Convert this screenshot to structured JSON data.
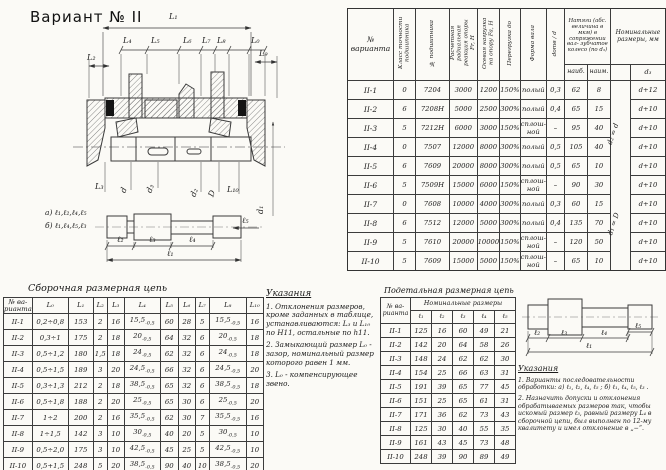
{
  "page_title": "Вариант № II",
  "drawing": {
    "dim_labels": {
      "L1": "L₁",
      "L2": "L₂",
      "L4": "L₄",
      "L5": "L₅",
      "L6": "L₆",
      "L7": "L₇",
      "L8": "L₈",
      "L0": "L₀",
      "L9": "L₉",
      "L3": "L₃",
      "d": "d",
      "d3": "d₃",
      "d2": "d₂",
      "D": "D",
      "L10": "L₁₀",
      "d1": "d₁"
    },
    "variant_note_a": "а) ℓ₁,ℓ₂,ℓ₄,ℓ₅",
    "variant_note_b": "б) ℓ₁,ℓ₄,ℓ₅,ℓ₃",
    "shaft_dims": {
      "l1": "ℓ₁",
      "l2": "ℓ₂",
      "l3": "ℓ₃",
      "l4": "ℓ₄",
      "l5": "ℓ₅"
    }
  },
  "main_table": {
    "headers": {
      "variant": "№ варианта",
      "accuracy_class": "Класс точности подшипника",
      "bearing_no": "№ подшипника",
      "radial_reaction": "Расчетная радиальная реакция опоры Fr, Н",
      "axial_load": "Осевая нагрузка на опору Fa, Н",
      "overload": "Перегрузка до",
      "shaft_form": "Форма вала",
      "d_ratio": "dотв / d",
      "interference": "Натяги (абс. величина в мкм) в сопряжении вал- зубчатое колесо (по d₃)",
      "max": "наиб.",
      "min": "наим.",
      "nominal": "Номинальные размеры, мм",
      "d3": "d₃"
    },
    "rot_top": "d₂ = d",
    "rot_bottom": "d₁ = D",
    "rows": [
      [
        "II-1",
        "0",
        "7204",
        "3000",
        "1200",
        "150%",
        "полый",
        "0,3",
        "62",
        "8",
        "",
        "d+12"
      ],
      [
        "II-2",
        "6",
        "7208Н",
        "5000",
        "2500",
        "300%",
        "полый",
        "0,4",
        "65",
        "15",
        "",
        "d+10"
      ],
      [
        "II-3",
        "5",
        "7212Н",
        "6000",
        "3000",
        "150%",
        "сплош-ной",
        "–",
        "95",
        "40",
        "",
        "d+10"
      ],
      [
        "II-4",
        "0",
        "7507",
        "12000",
        "8000",
        "300%",
        "полый",
        "0,5",
        "105",
        "40",
        "",
        "d+10"
      ],
      [
        "II-5",
        "6",
        "7609",
        "20000",
        "8000",
        "300%",
        "полый",
        "0,5",
        "65",
        "10",
        "",
        "d+10"
      ],
      [
        "II-6",
        "5",
        "7509Н",
        "15000",
        "6000",
        "150%",
        "сплош-ной",
        "–",
        "90",
        "30",
        "",
        "d+10"
      ],
      [
        "II-7",
        "0",
        "7608",
        "10000",
        "4000",
        "300%",
        "полый",
        "0,3",
        "60",
        "15",
        "",
        "d+10"
      ],
      [
        "II-8",
        "6",
        "7512",
        "12000",
        "5000",
        "300%",
        "полый",
        "0,4",
        "135",
        "70",
        "",
        "d+10"
      ],
      [
        "II-9",
        "5",
        "7610",
        "20000",
        "10000",
        "150%",
        "сплош-ной",
        "–",
        "120",
        "50",
        "",
        "d+10"
      ],
      [
        "II-10",
        "5",
        "7609",
        "15000",
        "5000",
        "150%",
        "сплош-ной",
        "–",
        "65",
        "10",
        "",
        "d+10"
      ]
    ]
  },
  "assembly_chain": {
    "title": "Сборочная размерная цепь",
    "headers": [
      "№ ва-рианта",
      "L₀",
      "L₁",
      "L₂",
      "L₃",
      "L₄",
      "L₅",
      "L₆",
      "L₇",
      "L₈",
      "L₁₀"
    ],
    "rows": [
      [
        "II-1",
        "0,2÷0,8",
        "153",
        "2",
        "16",
        "15,5_{-0,5}",
        "60",
        "28",
        "5",
        "15,5_{-0,5}",
        "16"
      ],
      [
        "II-2",
        "0,3÷1",
        "175",
        "2",
        "18",
        "20_{-0,5}",
        "64",
        "32",
        "6",
        "20_{-0,5}",
        "18"
      ],
      [
        "II-3",
        "0,5÷1,2",
        "180",
        "1,5",
        "18",
        "24_{-0,5}",
        "62",
        "32",
        "6",
        "24_{-0,5}",
        "18"
      ],
      [
        "II-4",
        "0,5÷1,5",
        "189",
        "3",
        "20",
        "24,5_{-0,5}",
        "66",
        "32",
        "6",
        "24,5_{-0,5}",
        "20"
      ],
      [
        "II-5",
        "0,3÷1,3",
        "212",
        "2",
        "18",
        "38,5_{-0,5}",
        "65",
        "32",
        "6",
        "38,5_{-0,5}",
        "18"
      ],
      [
        "II-6",
        "0,5÷1,8",
        "188",
        "2",
        "20",
        "25_{-0,5}",
        "65",
        "30",
        "6",
        "25_{-0,5}",
        "20"
      ],
      [
        "II-7",
        "1÷2",
        "200",
        "2",
        "16",
        "35,5_{-0,5}",
        "62",
        "30",
        "7",
        "35,5_{-0,5}",
        "16"
      ],
      [
        "II-8",
        "1÷1,5",
        "142",
        "3",
        "10",
        "30_{-0,5}",
        "40",
        "20",
        "5",
        "30_{-0,5}",
        "10"
      ],
      [
        "II-9",
        "0,5÷2,0",
        "175",
        "3",
        "10",
        "42,5_{-0,5}",
        "45",
        "25",
        "5",
        "42,5_{-0,5}",
        "10"
      ],
      [
        "II-10",
        "0,5+1,5",
        "248",
        "5",
        "20",
        "38,5_{-0,5}",
        "90",
        "40",
        "10",
        "38,5_{-0,5}",
        "20"
      ]
    ]
  },
  "instructions_mid": {
    "title": "Указания",
    "items": [
      "1. Отклонения размеров, кроме заданных в таблице, устанавливаются: L₃ и L₁₀ по H11, остальные по h11.",
      "2. Замыкающий размер L₀ - зазор, номинальный размер которого равен 1 мм.",
      "3. L₀ - компенсирующее звено."
    ]
  },
  "detail_chain": {
    "title": "Подетальная размерная цепь",
    "col_variant": "№ ва-рианта",
    "group_header": "Номинальные размеры",
    "headers": [
      "ℓ₁",
      "ℓ₂",
      "ℓ₃",
      "ℓ₄",
      "ℓ₅"
    ],
    "rows": [
      [
        "II-1",
        "125",
        "16",
        "60",
        "49",
        "21"
      ],
      [
        "II-2",
        "142",
        "20",
        "64",
        "58",
        "26"
      ],
      [
        "II-3",
        "148",
        "24",
        "62",
        "62",
        "30"
      ],
      [
        "II-4",
        "154",
        "25",
        "66",
        "63",
        "31"
      ],
      [
        "II-5",
        "191",
        "39",
        "65",
        "77",
        "45"
      ],
      [
        "II-6",
        "151",
        "25",
        "65",
        "61",
        "31"
      ],
      [
        "II-7",
        "171",
        "36",
        "62",
        "73",
        "43"
      ],
      [
        "II-8",
        "125",
        "30",
        "40",
        "55",
        "35"
      ],
      [
        "II-9",
        "161",
        "43",
        "45",
        "73",
        "48"
      ],
      [
        "II-10",
        "248",
        "39",
        "90",
        "89",
        "49"
      ]
    ]
  },
  "detail_drawing": {
    "dims": {
      "l1": "ℓ₁",
      "l2": "ℓ₂",
      "l3": "ℓ₃",
      "l4": "ℓ₄",
      "l5": "ℓ₅"
    }
  },
  "instructions_right": {
    "title": "Указания",
    "items": [
      "1. Варианты последовательности обработки:  а) ℓ₁, ℓ₂, ℓ₄, ℓ₅ ;   б) ℓ₁, ℓ₄, ℓ₅, ℓ₃ .",
      "2. Назначить допуски и отклонения обрабатываемых размеров так, чтобы искомый размер ℓ₃, равный размеру L₄ в сборочной цепи, был выполнен по 12-му квалитету и имел отклонение в „−“."
    ]
  }
}
